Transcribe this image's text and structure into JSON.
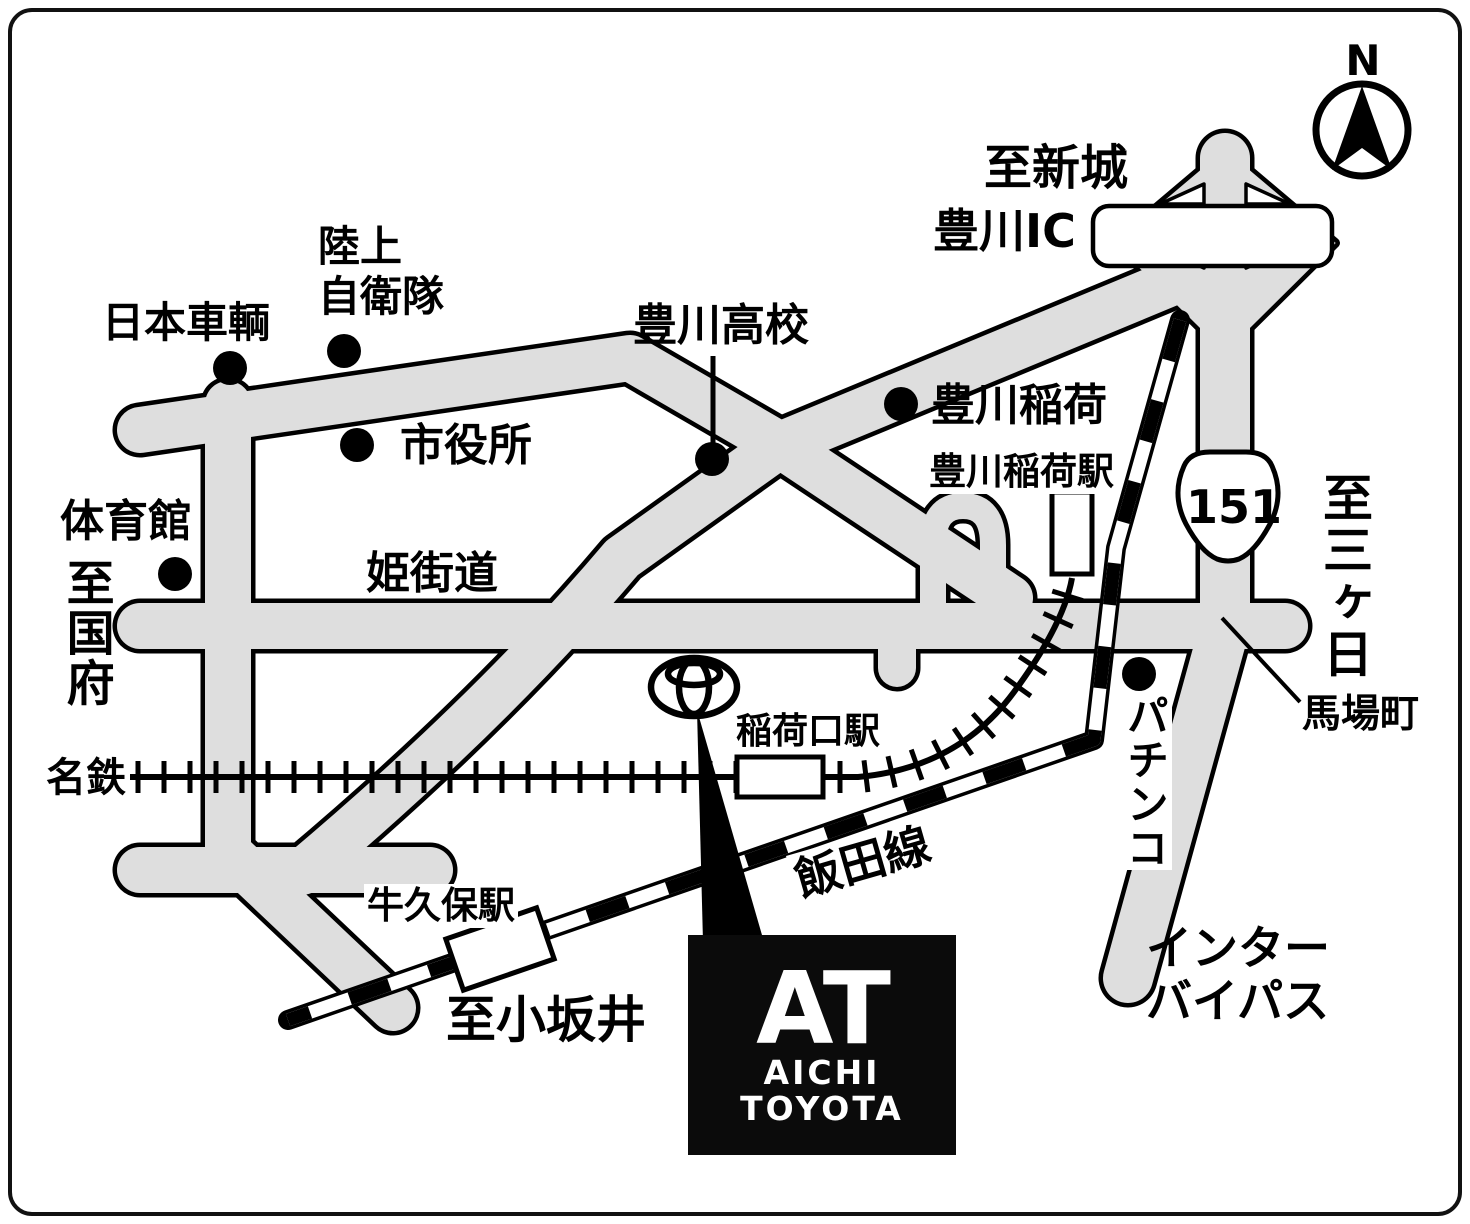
{
  "map": {
    "compass": {
      "north_label": "N"
    },
    "route_badge": {
      "number": "151"
    },
    "destinations": {
      "shinshiro": "至新城",
      "mikkabi": "至三ヶ日",
      "kokufu": "至国府",
      "kozakai": "至小坂井"
    },
    "roads": {
      "himekaido": "姫街道",
      "inter_bypass": "インター\nバイパス",
      "baba_cho": "馬場町"
    },
    "railways": {
      "meitetsu": "名鉄",
      "iida_line": "飯田線"
    },
    "stations": {
      "toyokawa_inari_station": "豊川稲荷駅",
      "inariguchi_station": "稲荷口駅",
      "ushikubo_station": "牛久保駅"
    },
    "landmarks": {
      "toyokawa_ic": "豊川IC",
      "rikujo_jieitai": "陸上\n自衛隊",
      "nihon_sharyo": "日本車輌",
      "shiyakusho": "市役所",
      "toyokawa_koko": "豊川高校",
      "toyokawa_inari": "豊川稲荷",
      "taiikukan": "体育館",
      "pachinko": "パチンコ"
    },
    "logo": {
      "monogram": "AT",
      "line1": "AICHI",
      "line2": "TOYOTA"
    },
    "colors": {
      "road_fill": "#dedede",
      "road_stroke": "#000000",
      "background": "#ffffff",
      "logo_box": "#0b0b0b"
    }
  }
}
